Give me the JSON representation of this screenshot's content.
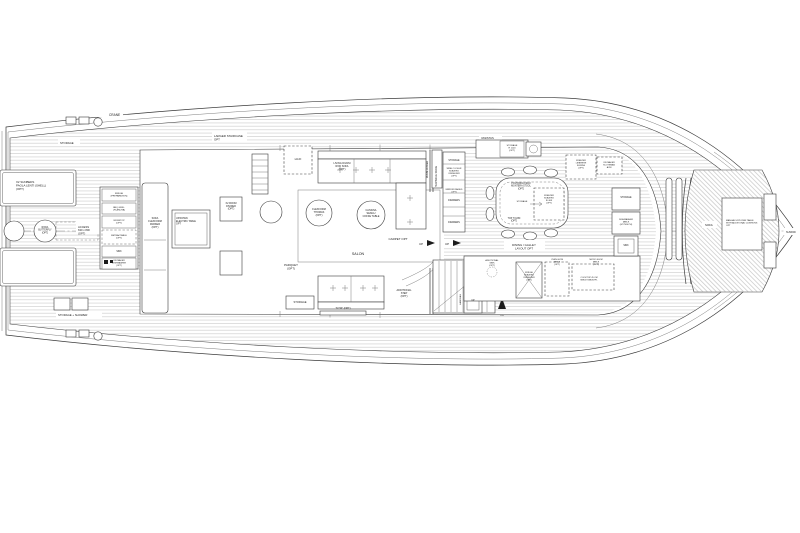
{
  "canvas": {
    "width": 800,
    "height": 533,
    "background": "#ffffff",
    "ink": "#3a3a3a",
    "plank": "#b5b5b5"
  },
  "drawing_type": "yacht-main-deck-floor-plan",
  "labels": [
    {
      "id": "crane",
      "lines": [
        "CRANE"
      ],
      "x": 109,
      "y": 116,
      "fs": 3.2,
      "anchor": "s"
    },
    {
      "id": "storage-aft-top",
      "lines": [
        "STORAGE"
      ],
      "x": 60,
      "y": 144,
      "fs": 2.8,
      "anchor": "s"
    },
    {
      "id": "sunbeds",
      "lines": [
        "X2 SUNBEDS",
        "PAOLA LENTI (SHELL)",
        "(OPT)"
      ],
      "x": 16,
      "y": 183,
      "fs": 2.9,
      "anchor": "s"
    },
    {
      "id": "roda-butterfly",
      "lines": [
        "RODA",
        "BUTTERFLY",
        "(OPT)"
      ],
      "x": 45,
      "y": 228,
      "fs": 2.3,
      "anchor": "m"
    },
    {
      "id": "access",
      "lines": [
        "ACCESS",
        "630 x 800",
        "(OPT)"
      ],
      "x": 78,
      "y": 228,
      "fs": 2.7,
      "anchor": "s"
    },
    {
      "id": "fridge-preparation",
      "lines": [
        "FRIDGE",
        "(PREPARATION)"
      ],
      "x": 119,
      "y": 194,
      "fs": 2.2,
      "anchor": "m"
    },
    {
      "id": "bbq-grill",
      "lines": [
        "BBQ GRILL",
        "(PLANCHA)"
      ],
      "x": 119,
      "y": 208,
      "fs": 2.2,
      "anchor": "m"
    },
    {
      "id": "worktop",
      "lines": [
        "WORKTOP",
        "(OPT)"
      ],
      "x": 119,
      "y": 221,
      "fs": 2.2,
      "anchor": "m"
    },
    {
      "id": "retractable",
      "lines": [
        "RETRACTABLE",
        "(OPT)"
      ],
      "x": 119,
      "y": 236,
      "fs": 2.2,
      "anchor": "m"
    },
    {
      "id": "sink-aft",
      "lines": [
        "SINK"
      ],
      "x": 119,
      "y": 252,
      "fs": 2.3,
      "anchor": "m"
    },
    {
      "id": "icemaker-aft",
      "lines": [
        "ICE MAKER",
        "DISHWASHER",
        "(OPT)"
      ],
      "x": 119,
      "y": 261,
      "fs": 2.1,
      "anchor": "m"
    },
    {
      "id": "storage-shower",
      "lines": [
        "STORAGE + SHOWER"
      ],
      "x": 58,
      "y": 316,
      "fs": 2.8,
      "anchor": "s"
    },
    {
      "id": "larger-staircase",
      "lines": [
        "LARGER STAIRCASE",
        "OPT"
      ],
      "x": 214,
      "y": 137,
      "fs": 2.9,
      "anchor": "s"
    },
    {
      "id": "hifi",
      "lines": [
        "HI-FI"
      ],
      "x": 298,
      "y": 160,
      "fs": 3,
      "anchor": "m"
    },
    {
      "id": "rod-sofa",
      "lines": [
        "LIVING DIVANI",
        "ROD SOFA",
        "(OPT)"
      ],
      "x": 342,
      "y": 164,
      "fs": 2.5,
      "anchor": "m"
    },
    {
      "id": "room-divider-wall",
      "lines": [
        "ROOM DIVIDER"
      ],
      "x": 428,
      "y": 178,
      "fs": 2.3,
      "anchor": "s",
      "rot": -90
    },
    {
      "id": "flexform-thomas",
      "lines": [
        "FLEXFORM",
        "THOMAS",
        "(OPT)"
      ],
      "x": 319,
      "y": 210,
      "fs": 2.5,
      "anchor": "m"
    },
    {
      "id": "coffee-table",
      "lines": [
        "CASSINA",
        "SENGU",
        "COFFE TABLE"
      ],
      "x": 371,
      "y": 211,
      "fs": 2.5,
      "anchor": "m"
    },
    {
      "id": "carpet",
      "lines": [
        "CARPET OPT"
      ],
      "x": 398,
      "y": 240,
      "fs": 3,
      "anchor": "m"
    },
    {
      "id": "salon",
      "lines": [
        "SALON"
      ],
      "x": 358,
      "y": 255,
      "fs": 3.6,
      "anchor": "m"
    },
    {
      "id": "parquet",
      "lines": [
        "PARQUET",
        "(OPT)"
      ],
      "x": 291,
      "y": 266,
      "fs": 2.9,
      "anchor": "m"
    },
    {
      "id": "storage-salon",
      "lines": [
        "STORAGE"
      ],
      "x": 300,
      "y": 303,
      "fs": 2.7,
      "anchor": "m"
    },
    {
      "id": "tv",
      "lines": [
        "TV 50\" (OPT)"
      ],
      "x": 343,
      "y": 309,
      "fs": 2.5,
      "anchor": "m"
    },
    {
      "id": "additional-step",
      "lines": [
        "ADDITIONAL",
        "STEP",
        "(OPT)"
      ],
      "x": 404,
      "y": 291,
      "fs": 2.5,
      "anchor": "m"
    },
    {
      "id": "up-1",
      "lines": [
        "UP"
      ],
      "x": 419,
      "y": 245,
      "fs": 2.9,
      "anchor": "s"
    },
    {
      "id": "up-2",
      "lines": [
        "UP"
      ],
      "x": 445,
      "y": 245,
      "fs": 2.9,
      "anchor": "s"
    },
    {
      "id": "sofa-parker",
      "lines": [
        "SOFA",
        "FLEXFORM",
        "PARKER",
        "(OPT)"
      ],
      "x": 155,
      "y": 219,
      "fs": 2.5,
      "anchor": "m"
    },
    {
      "id": "electric-table",
      "lines": [
        "UP/DOWN",
        "ELECTRIC TABLE",
        "OPT"
      ],
      "x": 176,
      "y": 219,
      "fs": 2.4,
      "anchor": "s"
    },
    {
      "id": "x2-room-divider",
      "lines": [
        "X2 ROOM",
        "DIVIDER",
        "(OPT)"
      ],
      "x": 231,
      "y": 204,
      "fs": 2.4,
      "anchor": "m"
    },
    {
      "id": "handrail",
      "lines": [
        "HANDRAIL"
      ],
      "x": 461,
      "y": 305,
      "fs": 2.2,
      "anchor": "s",
      "rot": -90
    },
    {
      "id": "technical-space",
      "lines": [
        "TECHNICAL SPACE"
      ],
      "x": 437,
      "y": 187,
      "fs": 2.3,
      "anchor": "s",
      "rot": -90
    },
    {
      "id": "vasistas",
      "lines": [
        "VASISTAS"
      ],
      "x": 481,
      "y": 139,
      "fs": 2.7,
      "anchor": "s"
    },
    {
      "id": "storage-h1100",
      "lines": [
        "STORAGE",
        "H 1100",
        "(OPT)"
      ],
      "x": 512,
      "y": 146,
      "fs": 2.2,
      "anchor": "m"
    },
    {
      "id": "storage-cabinet",
      "lines": [
        "STORAGE"
      ],
      "x": 454,
      "y": 161,
      "fs": 2.3,
      "anchor": "m"
    },
    {
      "id": "wine-cooler",
      "lines": [
        "WINE COOLER",
        "SUBZERO",
        "ICBDE030R",
        "(OPT)"
      ],
      "x": 454,
      "y": 169,
      "fs": 2.1,
      "anchor": "m"
    },
    {
      "id": "mirror-raised",
      "lines": [
        "MIRROR RAISED",
        "(OPT)"
      ],
      "x": 454,
      "y": 190,
      "fs": 2.1,
      "anchor": "m"
    },
    {
      "id": "drawers-1",
      "lines": [
        "DRAWERS"
      ],
      "x": 454,
      "y": 201,
      "fs": 2.3,
      "anchor": "m"
    },
    {
      "id": "drawers-2",
      "lines": [
        "DRAWERS"
      ],
      "x": 454,
      "y": 223,
      "fs": 2.3,
      "anchor": "m"
    },
    {
      "id": "montera-stool",
      "lines": [
        "POLTRONA FRAU",
        "MONTERA STOOL",
        "(OPT)"
      ],
      "x": 521,
      "y": 184,
      "fs": 2.3,
      "anchor": "m"
    },
    {
      "id": "storage-table",
      "lines": [
        "STORAGE"
      ],
      "x": 522,
      "y": 202,
      "fs": 2.2,
      "anchor": "m"
    },
    {
      "id": "freezer-id30f",
      "lines": [
        "FREEZER",
        "SUBZERO",
        "ID-30F",
        "(OPT)"
      ],
      "x": 549,
      "y": 196,
      "fs": 2.1,
      "anchor": "m"
    },
    {
      "id": "top-h1050",
      "lines": [
        "TOP H 1050",
        "(OPT)"
      ],
      "x": 514,
      "y": 219,
      "fs": 2.3,
      "anchor": "m"
    },
    {
      "id": "freezer-liebherr",
      "lines": [
        "FREEZER",
        "LIEBHERR",
        "SUFSN0",
        "(OPT)"
      ],
      "x": 581,
      "y": 161,
      "fs": 2.1,
      "anchor": "m"
    },
    {
      "id": "icemaker-scotsman",
      "lines": [
        "ICE MAKER",
        "SCOTSMAN",
        "ACM"
      ],
      "x": 609,
      "y": 163,
      "fs": 2.1,
      "anchor": "m"
    },
    {
      "id": "dining-galley",
      "lines": [
        "DINING / GALLEY",
        "LAYOUT OPT"
      ],
      "x": 524,
      "y": 246,
      "fs": 2.9,
      "anchor": "m"
    },
    {
      "id": "additional-sink",
      "lines": [
        "ADDITIONAL",
        "SINK",
        "(OPT)"
      ],
      "x": 492,
      "y": 261,
      "fs": 2.2,
      "anchor": "m"
    },
    {
      "id": "oven",
      "lines": [
        "OVEN 60CM",
        "MIELE",
        "(OPT)"
      ],
      "x": 557,
      "y": 260,
      "fs": 2.1,
      "anchor": "m"
    },
    {
      "id": "micro",
      "lines": [
        "MICRO 60CM",
        "MIELE",
        "(OPT)"
      ],
      "x": 596,
      "y": 260,
      "fs": 2.1,
      "anchor": "m"
    },
    {
      "id": "fridge-galley",
      "lines": [
        "FRIDGE",
        "SUBZERO",
        "ICBDE030R",
        "(OPT)"
      ],
      "x": 529,
      "y": 273,
      "fs": 2.1,
      "anchor": "m"
    },
    {
      "id": "cooktop",
      "lines": [
        "COOKTOP 45 CM",
        "MIELE KM6357FL"
      ],
      "x": 589,
      "y": 278,
      "fs": 2.1,
      "anchor": "m"
    },
    {
      "id": "storage-stbd",
      "lines": [
        "STORAGE"
      ],
      "x": 626,
      "y": 198,
      "fs": 2.3,
      "anchor": "m"
    },
    {
      "id": "dishwasher",
      "lines": [
        "DISHWASHER",
        "MIELE",
        "(G7790SCVI)"
      ],
      "x": 626,
      "y": 220,
      "fs": 2.1,
      "anchor": "m"
    },
    {
      "id": "sink-stbd",
      "lines": [
        "SINK"
      ],
      "x": 626,
      "y": 246,
      "fs": 2.3,
      "anchor": "m"
    },
    {
      "id": "up-lift",
      "lines": [
        "UP"
      ],
      "x": 473,
      "y": 301,
      "fs": 2.3,
      "anchor": "m"
    },
    {
      "id": "dn",
      "lines": [
        "DN"
      ],
      "x": 502,
      "y": 316,
      "fs": 2.2,
      "anchor": "m"
    },
    {
      "id": "sofa-bow",
      "lines": [
        "SOFA"
      ],
      "x": 705,
      "y": 226,
      "fs": 2.9,
      "anchor": "s"
    },
    {
      "id": "manual-table",
      "lines": [
        "MANUAL UP/DOWN TABLE",
        "WITH ADDITIONAL CUSHIONS",
        "OPT"
      ],
      "x": 726,
      "y": 221,
      "fs": 2.2,
      "anchor": "s"
    },
    {
      "id": "sunpad",
      "lines": [
        "SUNPAD"
      ],
      "x": 786,
      "y": 233,
      "fs": 2.4,
      "anchor": "s"
    }
  ]
}
